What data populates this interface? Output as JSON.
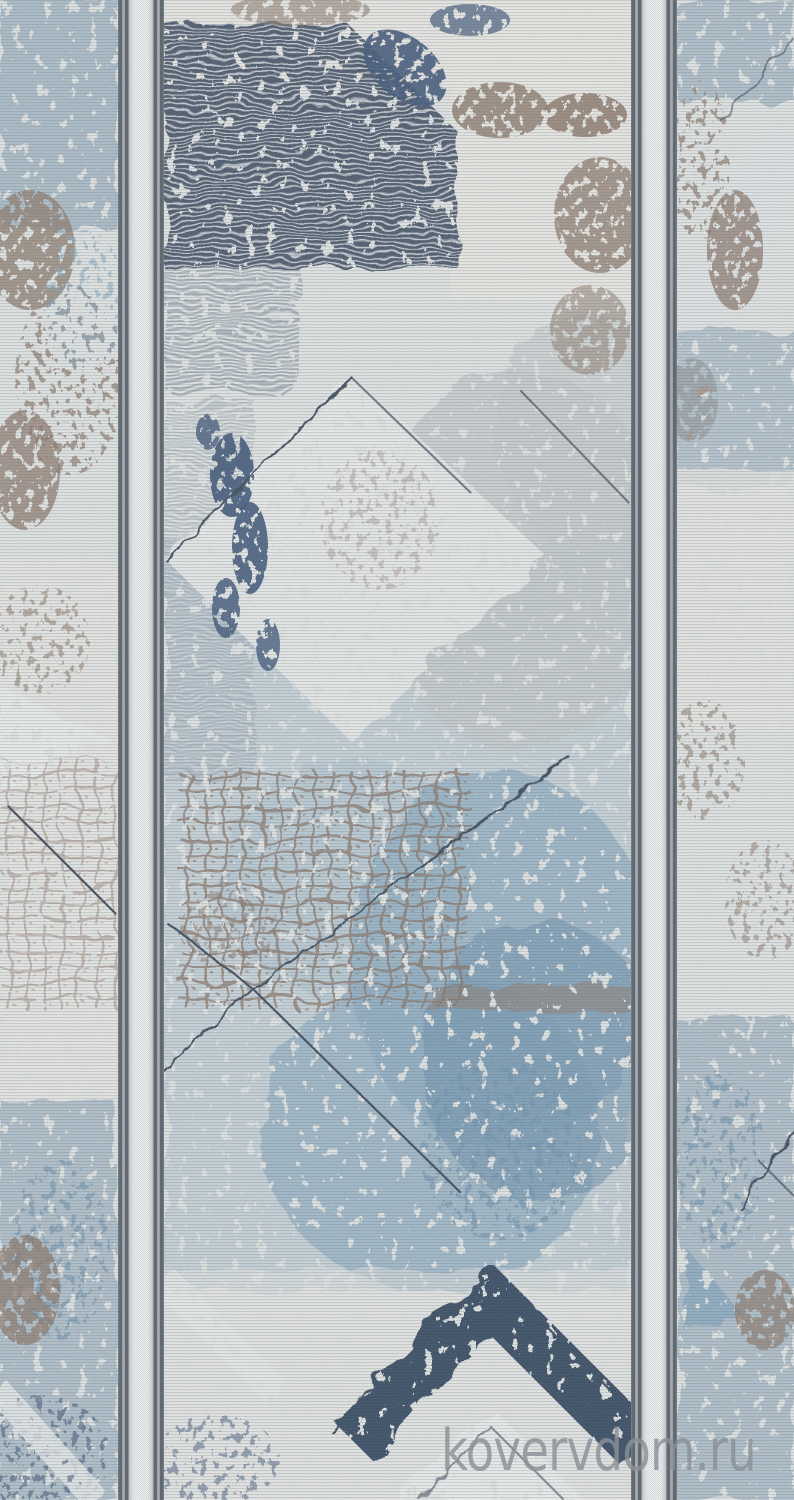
{
  "photo": {
    "subject": "distressed geometric runner rug with two vertical guard stripes"
  },
  "watermark": {
    "text": "kovervdom.ru"
  },
  "palette": {
    "base": "#e8eae8",
    "cream": "#efede8",
    "field-light": "#f1f2ef",
    "slate": "#4b586a",
    "stripe-light": "#dde1e4",
    "mid-stripe": "#8c98a5",
    "navy": "#3e5578",
    "chevron-navy": "#354960",
    "blue-soft": "#b6c9d4",
    "blue-mid": "#8fafc4",
    "blue-deep": "#6f94b0",
    "blue-strip": "#9db3c2",
    "taupe": "#94806f",
    "brown": "#8a7262",
    "gray-cloud": "#cdd1d1",
    "line": "#3d4a5a",
    "grain": "#5a646e",
    "band-edge": "#757c82",
    "band-dark": "#575e65",
    "band-mid": "#a8aeb3",
    "band-light": "#c6cacd",
    "band-pale": "#e9ebec",
    "band-white": "#f6f7f7",
    "white": "#f3f4f2",
    "watermark": "#8b9198"
  }
}
